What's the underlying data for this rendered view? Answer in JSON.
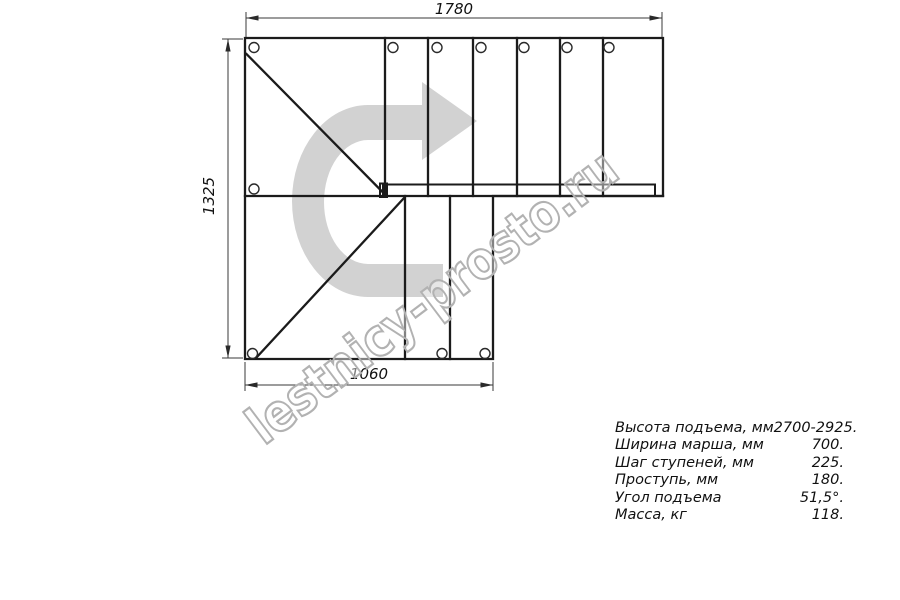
{
  "drawing": {
    "dimensions": {
      "top": "1780",
      "left": "1325",
      "bottom": "1060"
    },
    "watermark": "lestnicy-prosto.ru",
    "arrow_color": "#d2d2d2",
    "line_color": "#1b1b1b"
  },
  "specs": {
    "rows": [
      {
        "label": "Высота подъема, мм",
        "value": "2700-2925."
      },
      {
        "label": "Ширина марша, мм",
        "value": "700."
      },
      {
        "label": "Шаг ступеней, мм",
        "value": "225."
      },
      {
        "label": "Проступь, мм",
        "value": "180."
      },
      {
        "label": "Угол подъема",
        "value": "51,5°."
      },
      {
        "label": "Масса, кг",
        "value": "118."
      }
    ]
  }
}
